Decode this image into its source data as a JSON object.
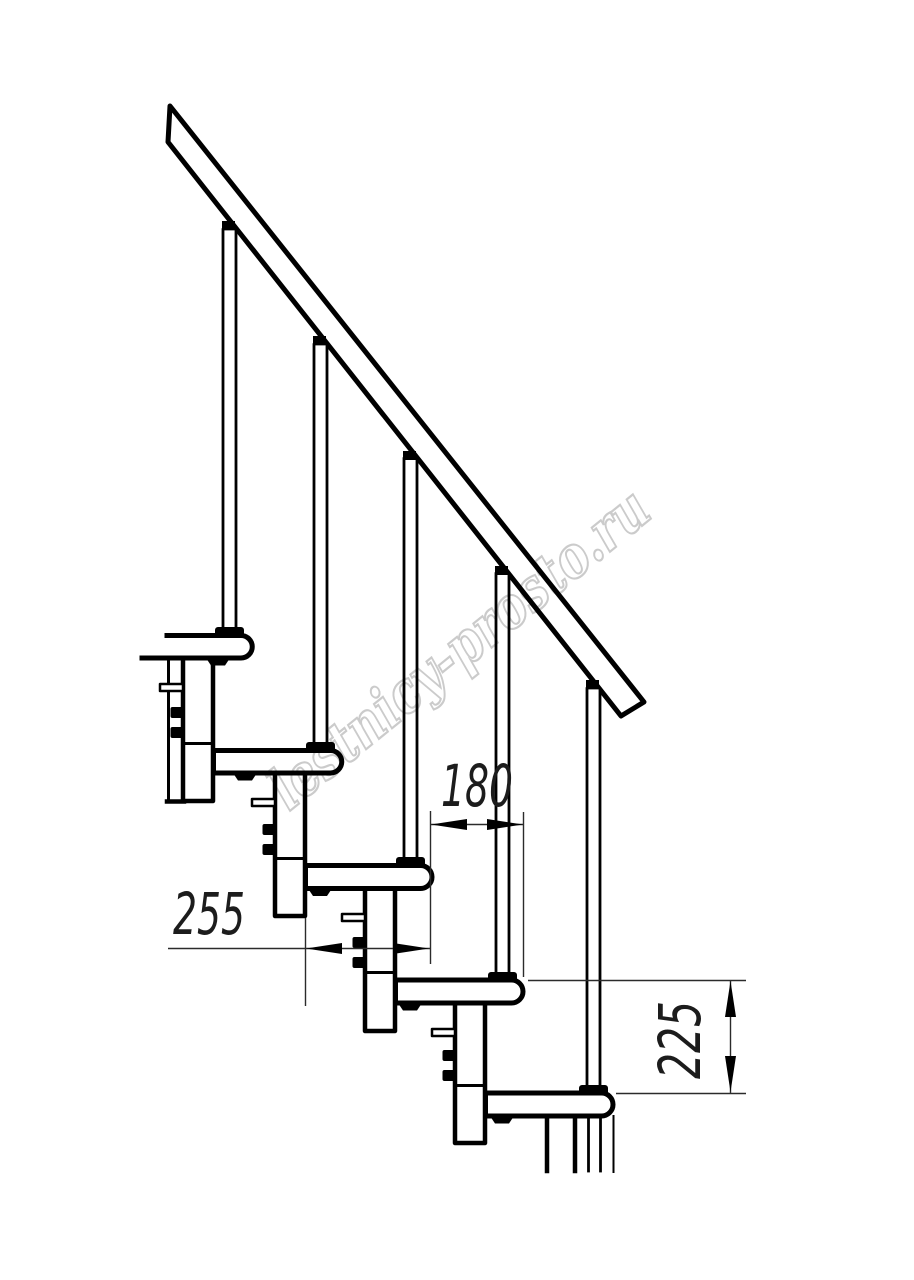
{
  "drawing": {
    "background_color": "#ffffff",
    "line_color": "#000000",
    "watermark": {
      "text": "lestnicy-prosto.ru",
      "color": "#c6c6c6"
    },
    "dimensions": {
      "step_offset": {
        "value": "180"
      },
      "tread_depth": {
        "value": "255"
      },
      "riser_height": {
        "value": "225"
      }
    },
    "counts": {
      "treads": 5,
      "balusters": 5
    }
  }
}
